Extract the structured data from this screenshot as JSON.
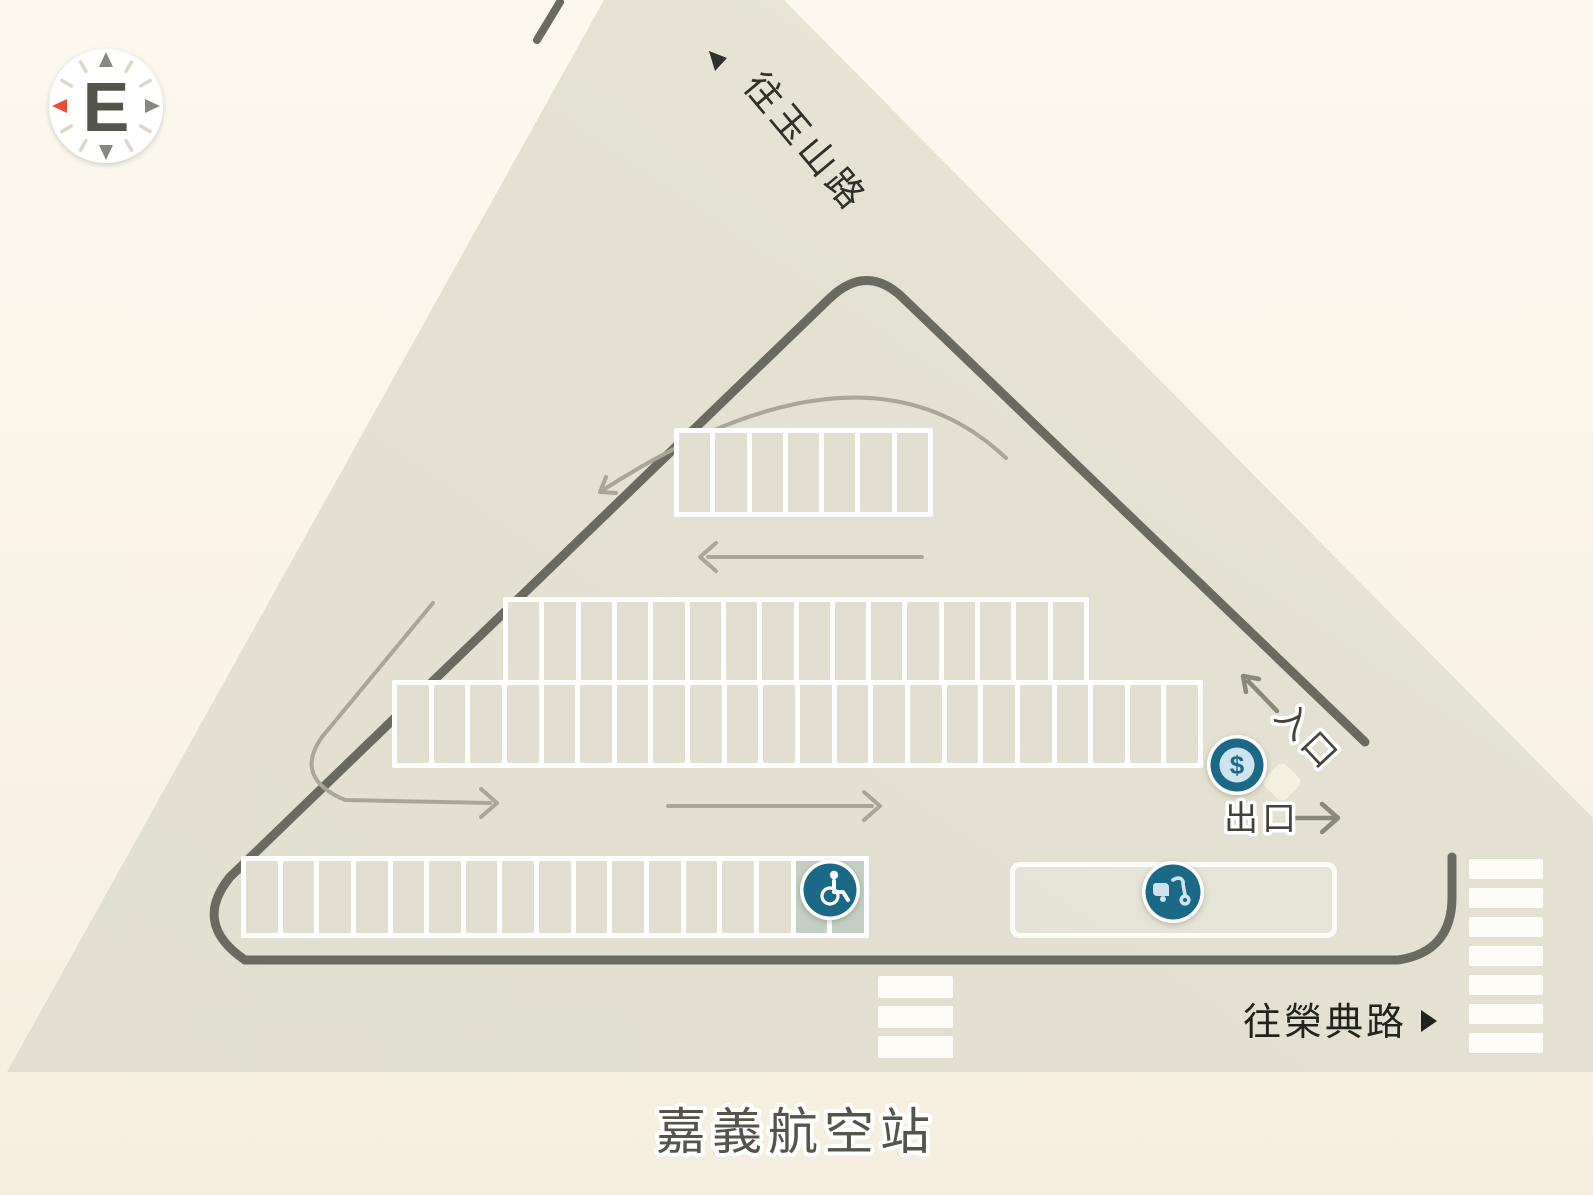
{
  "title": "嘉義航空站",
  "compass": {
    "letter": "E"
  },
  "roads": {
    "top_road_label": "往玉山路",
    "bottom_road_label": "往榮典路",
    "entrance_label": "入口",
    "exit_label": "出口"
  },
  "icons": {
    "toll": {
      "glyph": "$",
      "meaning": "toll-payment-booth"
    },
    "accessible": {
      "meaning": "accessible-parking"
    },
    "scooter": {
      "meaning": "motorcycle-parking"
    }
  },
  "colors": {
    "teal": "#1a6a87",
    "icon_light_blue": "#cfe3ed",
    "accessible_sage": "#c3cfc2",
    "compass_north_red": "#ee4c3b",
    "road_beige": "#e4e1d2",
    "loop_line": "#6b6a61",
    "label_dark": "#30302a"
  },
  "parking": {
    "rows": [
      {
        "name": "parking-row-top",
        "x": 674,
        "y": 428,
        "w": 259,
        "h": 89,
        "stalls": 7
      },
      {
        "name": "parking-row-middle-upper",
        "x": 503,
        "y": 597,
        "w": 586,
        "h": 88,
        "stalls": 16
      },
      {
        "name": "parking-row-middle-lower",
        "x": 392,
        "y": 680,
        "w": 811,
        "h": 88,
        "stalls": 22
      },
      {
        "name": "parking-row-bottom",
        "x": 241,
        "y": 856,
        "w": 628,
        "h": 82,
        "stalls": 17,
        "accessible": 2
      }
    ],
    "moto_area": {
      "x": 1010,
      "y": 862,
      "w": 327,
      "h": 76
    }
  },
  "crosswalks": [
    {
      "name": "crosswalk-bottom",
      "x": 878,
      "y": 976,
      "bar_w": 75,
      "bar_h": 22,
      "count": 3,
      "pitch": 30
    },
    {
      "name": "crosswalk-right",
      "x": 1469,
      "y": 859,
      "bar_w": 74,
      "bar_h": 20,
      "count": 7,
      "pitch": 29
    }
  ]
}
